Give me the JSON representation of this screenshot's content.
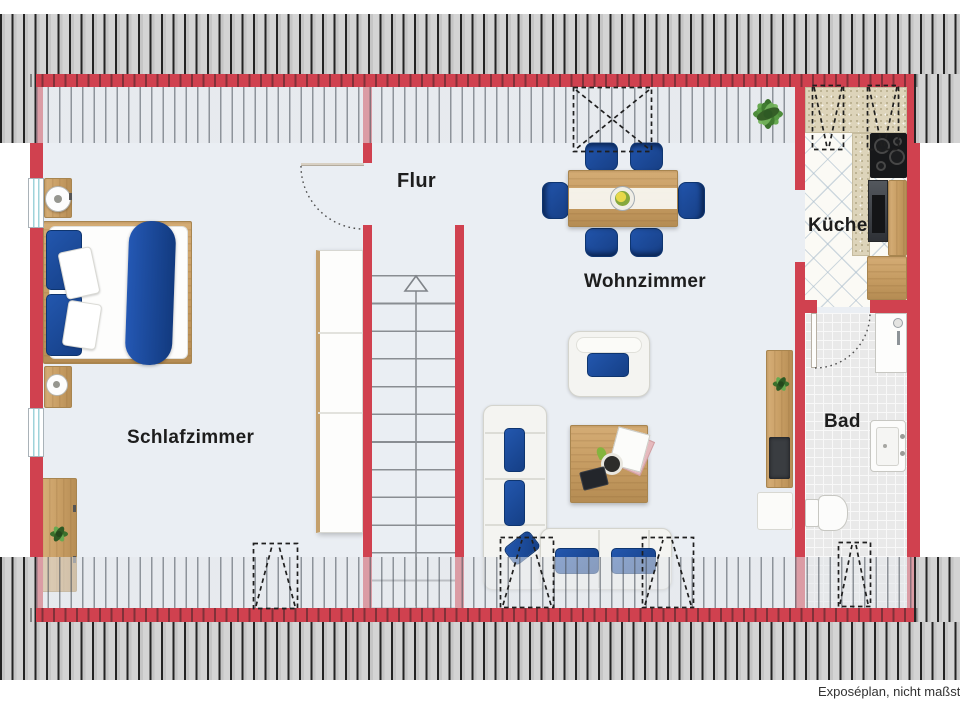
{
  "rooms": [
    {
      "id": "schlafzimmer",
      "label": "Schlafzimmer"
    },
    {
      "id": "flur",
      "label": "Flur"
    },
    {
      "id": "wohnzimmer",
      "label": "Wohnzimmer"
    },
    {
      "id": "kueche",
      "label": "Küche"
    },
    {
      "id": "bad",
      "label": "Bad"
    }
  ],
  "footer": {
    "note": "Exposéplan, nicht maßstäblich"
  },
  "colors": {
    "wall": "#d0414f",
    "floor": "#eaeef3",
    "furniture_blue": "#1d4fa0",
    "wood": "#c9a36b",
    "roof_hatch_dark": "#c9c9c9",
    "roof_hatch_light": "#e4e7ea",
    "plant_green": "#4e8d3b"
  },
  "furniture": [
    "double-bed",
    "nightstand",
    "bedside-lamp",
    "wardrobe",
    "dresser",
    "stairs-up",
    "dining-table",
    "fruit-bowl",
    "dining-chair",
    "potted-plant",
    "armchair",
    "sofa-l-shape",
    "coffee-table",
    "magazine",
    "coffee-cup",
    "tablet",
    "tv-sideboard",
    "tv",
    "kitchen-counter",
    "cooktop",
    "oven",
    "kitchen-cabinet",
    "shower",
    "bathroom-sink",
    "toilet",
    "skylight-window",
    "window",
    "door-swing"
  ]
}
